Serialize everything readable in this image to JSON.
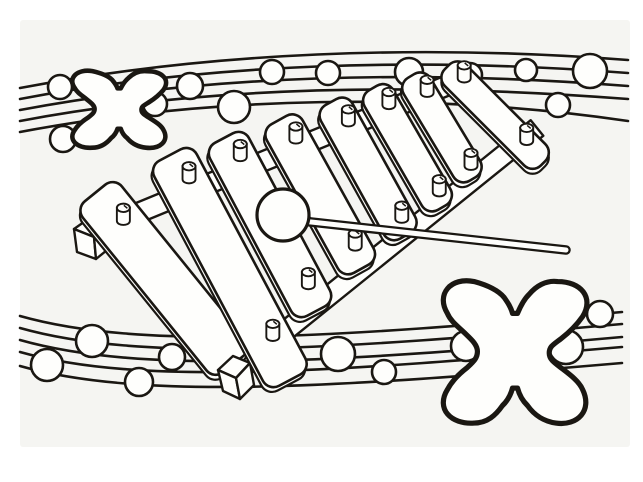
{
  "scene": {
    "description": "Black and white coloring page: the letter X with a xylophone and mallet, decorated with wavy music staff lines and round beads",
    "letter": "X",
    "paper": "#ffffff",
    "paper_tint": "#f5f5f2",
    "ink": "#1a1712",
    "shape_fill": "#fefefc",
    "counts": {
      "bars": 8,
      "top_balls": 12,
      "bottom_balls": 10,
      "letters": 2
    }
  },
  "glyph_path": "M 11,26 C 4,14 13,3 27,6 C 34,8 41,11 45,16 C 47,19 49,22 50,26 L 53,26 C 55,21 57,17 60,14 C 64,9 70,5 77,6 C 91,6 99,16 92,28 C 88,34 84,38 79,42 C 74,46 72,47 72,51 C 72,55 75,57 80,61 C 85,65 90,69 92,74 C 98,87 89,97 76,95 C 69,94 63,90 59,84 C 56,81 54,77 53,73 L 50,73 C 49,77 47,81 44,84 C 40,90 35,95 27,95 C 13,96 4,86 11,74 C 14,68 18,64 23,60 C 27,56 29,54 29,50 C 29,46 26,43 22,39 C 17,34 13,31 11,26 Z",
  "letters": [
    {
      "id": "top-left",
      "char": "X",
      "x": 63,
      "y": 66,
      "w": 109,
      "h": 86,
      "stroke_width": 4.6
    },
    {
      "id": "bottom-right",
      "char": "X",
      "x": 429,
      "y": 272,
      "w": 167,
      "h": 159,
      "stroke_width": 5.2
    }
  ],
  "staves": {
    "top": {
      "lines": [
        "M 20,88 C 210,52 420,44 628,60",
        "M 20,99 C 210,63 420,57 628,73",
        "M 20,110 C 210,74 420,70 628,86",
        "M 20,121 C 210,85 420,83 628,99",
        "M 20,132 C 210,96 430,92 628,121"
      ],
      "balls": [
        [
          60,
          87,
          12
        ],
        [
          63,
          139,
          13
        ],
        [
          155,
          104,
          12
        ],
        [
          190,
          86,
          13
        ],
        [
          234,
          107,
          16
        ],
        [
          272,
          72,
          12
        ],
        [
          328,
          73,
          12
        ],
        [
          409,
          72,
          14
        ],
        [
          470,
          75,
          12
        ],
        [
          526,
          70,
          11
        ],
        [
          590,
          71,
          17
        ],
        [
          558,
          105,
          12
        ]
      ]
    },
    "bottom": {
      "lines": [
        "M 20,316 C 140,350 330,338 622,312",
        "M 20,328 C 140,362 330,350 622,324",
        "M 20,340 C 140,374 330,363 622,337",
        "M 20,352 C 140,386 330,372 622,347",
        "M 20,366 C 140,400 330,388 622,363"
      ],
      "balls": [
        [
          47,
          365,
          16
        ],
        [
          92,
          341,
          16
        ],
        [
          139,
          382,
          14
        ],
        [
          172,
          357,
          13
        ],
        [
          219,
          356,
          14
        ],
        [
          338,
          354,
          17
        ],
        [
          384,
          372,
          12
        ],
        [
          466,
          346,
          15
        ],
        [
          566,
          347,
          17
        ],
        [
          600,
          314,
          13
        ]
      ]
    }
  },
  "xylophone": {
    "rails": [
      {
        "x1": 82,
        "y1": 236,
        "x2": 446,
        "y2": 86,
        "w": 20
      },
      {
        "x1": 232,
        "y1": 374,
        "x2": 537,
        "y2": 128,
        "w": 20
      }
    ],
    "cubes": [
      [
        "M 74,229 L 91,217 L 110,224 L 94,237 Z",
        "M 74,229 L 94,237 L 96,259 L 77,252 Z",
        "M 94,237 L 110,224 L 112,246 L 96,259 Z"
      ],
      [
        "M 218,370 L 233,356 L 250,363 L 236,378 Z",
        "M 218,370 L 236,378 L 240,399 L 223,391 Z",
        "M 236,378 L 250,363 L 254,385 L 240,399 Z"
      ]
    ],
    "bars": [
      {
        "top": [
          95,
          193
        ],
        "angle": 51,
        "len": 220,
        "w": 50,
        "pegs": [
          0.16
        ]
      },
      {
        "top": [
          170,
          155
        ],
        "angle": 62,
        "len": 255,
        "w": 48,
        "pegs": [
          0.1,
          0.8
        ]
      },
      {
        "top": [
          224,
          138
        ],
        "angle": 62,
        "len": 196,
        "w": 44,
        "pegs": [
          0.1,
          0.84
        ]
      },
      {
        "top": [
          279,
          120
        ],
        "angle": 61,
        "len": 170,
        "w": 41,
        "pegs": [
          0.12,
          0.84
        ]
      },
      {
        "top": [
          331,
          102
        ],
        "angle": 61,
        "len": 153,
        "w": 36,
        "pegs": [
          0.14,
          0.86
        ]
      },
      {
        "top": [
          373,
          88
        ],
        "angle": 60,
        "len": 138,
        "w": 33,
        "pegs": [
          0.13,
          0.86
        ]
      },
      {
        "top": [
          411,
          76
        ],
        "angle": 59,
        "len": 120,
        "w": 31,
        "pegs": [
          0.15,
          0.86
        ]
      },
      {
        "top": [
          447,
          67
        ],
        "angle": 45,
        "len": 136,
        "w": 30,
        "pegs": [
          0.12,
          0.77
        ]
      }
    ],
    "peg": {
      "rx": 6.5,
      "body_h": 15,
      "top_ry": 4.2
    },
    "bar_corner_radius": 12,
    "thickness_offset": [
      -3.5,
      3.5
    ]
  },
  "mallet": {
    "head": [
      283,
      215,
      26
    ],
    "stick": [
      302,
      221,
      566,
      250
    ],
    "stick_outer_w": 9.5,
    "stick_inner_w": 5
  }
}
